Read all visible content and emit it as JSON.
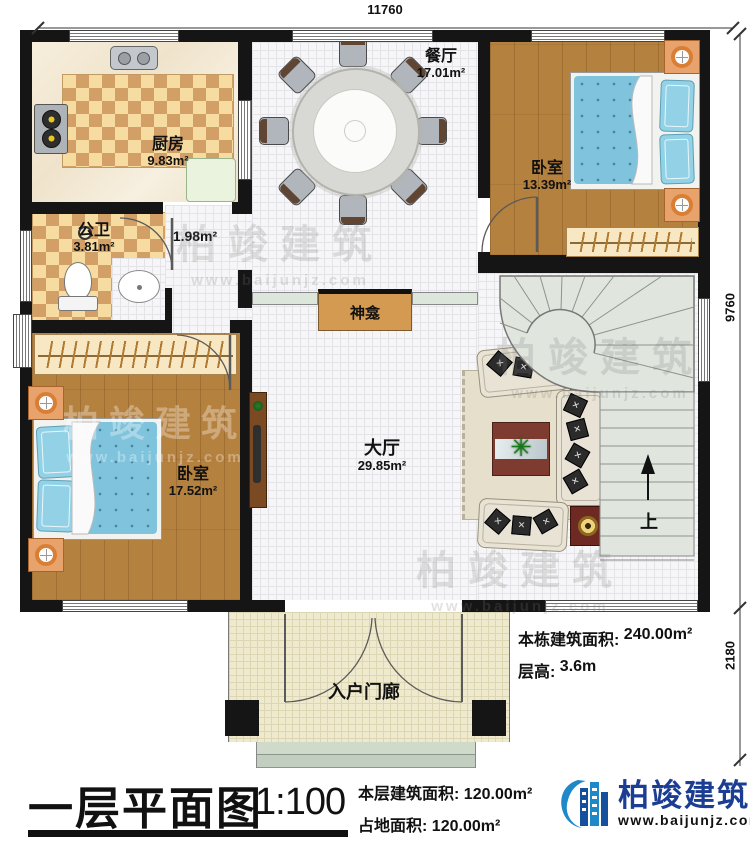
{
  "dimensions": {
    "width_top": "11760",
    "height_right_main": "9760",
    "height_right_porch": "2180"
  },
  "rooms": {
    "kitchen": {
      "name": "厨房",
      "area": "9.83m²"
    },
    "dining": {
      "name": "餐厅",
      "area": "17.01m²"
    },
    "bathroom": {
      "name": "公卫",
      "area": "3.81m²"
    },
    "hallway": {
      "area": "1.98m²"
    },
    "bedroom_right": {
      "name": "卧室",
      "area": "13.39m²"
    },
    "bedroom_left": {
      "name": "卧室",
      "area": "17.52m²"
    },
    "hall": {
      "name": "大厅",
      "area": "29.85m²"
    },
    "shrine": {
      "name": "神龛"
    },
    "porch": {
      "name": "入户门廊"
    },
    "stairs_up": "上"
  },
  "annotations": {
    "building_area_label": "本栋建筑面积:",
    "building_area_value": "240.00m²",
    "floor_height_label": "层高:",
    "floor_height_value": "3.6m"
  },
  "footer": {
    "title": "一层平面图",
    "scale": "1:100",
    "floor_area_label": "本层建筑面积:",
    "floor_area_value": "120.00m²",
    "land_area_label": "占地面积:",
    "land_area_value": "120.00m²",
    "brand_name": "柏竣建筑",
    "brand_site": "www.baijunjz.com"
  },
  "watermark": {
    "text": "柏竣建筑",
    "site": "www.baijunjz.com"
  },
  "colors": {
    "wall": "#151515",
    "wood": "#b5813f",
    "bed_blue": "#7fc4dc",
    "brand_blue": "#1b3e92"
  }
}
